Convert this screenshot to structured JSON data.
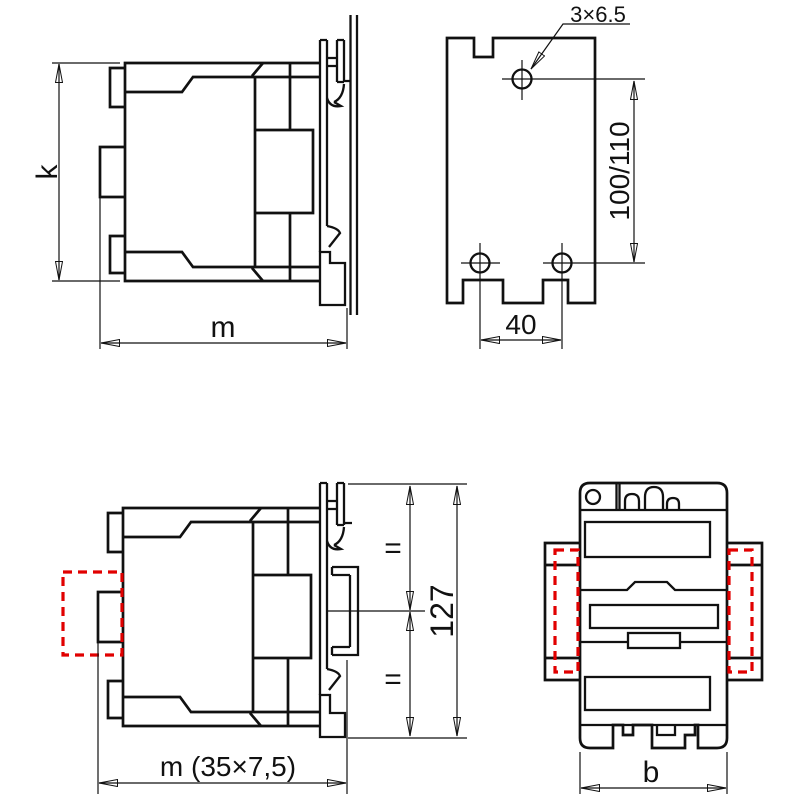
{
  "colors": {
    "line": "#111111",
    "highlight": "#e10000",
    "background": "#ffffff"
  },
  "labels": {
    "k": "k",
    "m": "m",
    "hole_callout": "3×6.5",
    "hole_row_spacing": "100/110",
    "hole_pitch": "40",
    "m_rail": "m (35×7,5)",
    "equal_upper": "=",
    "equal_lower": "=",
    "overall_height": "127",
    "b": "b"
  }
}
